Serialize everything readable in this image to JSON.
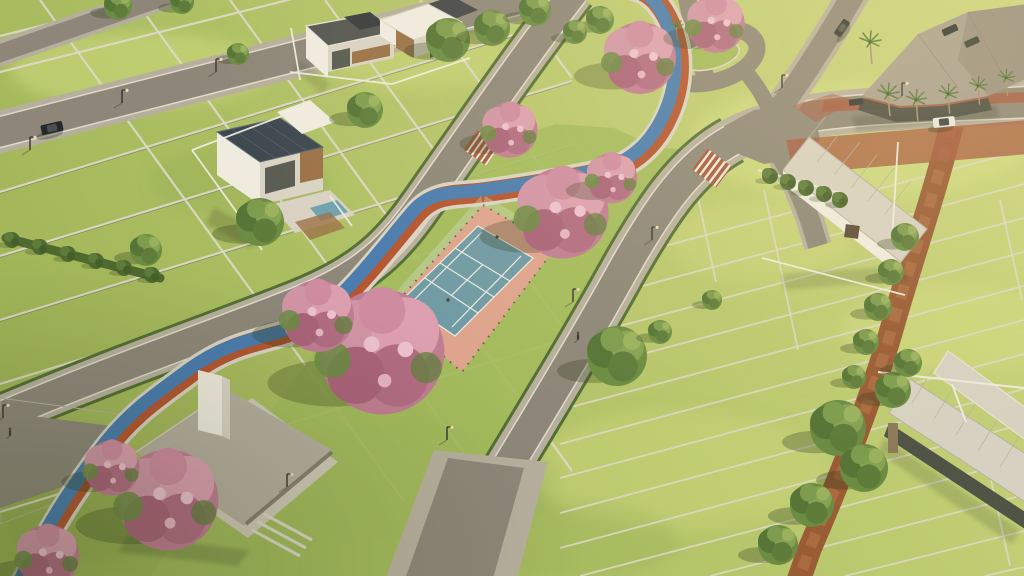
{
  "scene": {
    "type": "aerial-3d-render",
    "description": "High-angle golden-hour drone render of a master-planned residential land development: fenced grass lots in perspective grids, diagonal paved streets, a central linear park with a fenced tennis court, flowering pink ipe trees, a winding blue-and-orange multiuse trail, a hip-roof pavilion, model houses, a palm-fringed clubhouse, a roundabout and a red-brick paved avenue.",
    "time_of_day": "late-afternoon sun from upper right, long soft shadows to lower left",
    "text_visible": "none"
  },
  "palette": {
    "grass_base1": "#9cb254",
    "grass_base2": "#ccd67e",
    "grass_light": "#d6df85",
    "grass_mid": "#aabf60",
    "grass_dark": "#83a047",
    "park_green": "#a3ba5c",
    "asphalt": "#8e8779",
    "sidewalk": "#b7af9d",
    "curb": "#ded9c9",
    "trail_blue": "#4a7cae",
    "trail_red": "#b5552f",
    "trail_base": "#d9d3c3",
    "court_blue": "#6f9aa4",
    "court_apron": "#dea48d",
    "court_line": "#eef0e6",
    "dirt": "#9a5c35",
    "dirt_light": "#ae6f44",
    "brick": "#a6593f",
    "roof_taupe": "#b5ae9d",
    "roof_light": "#d7d1c1",
    "roof_dark": "#a79e8e",
    "roof_facet": "#998f7f",
    "wall": "#efebdf",
    "wall_shade": "#d9d3c4",
    "glass": "#42473f",
    "wood": "#9b7248",
    "solar": "#3d474f",
    "tree_dark": "#556f35",
    "tree_mid": "#6b8c42",
    "tree_light": "#8aa854",
    "bush": "#4e6a30",
    "pink": "#c07d92",
    "pink_light": "#dc9fb0",
    "pink_dark": "#aa6379",
    "car_dark": "#26292c",
    "car_white": "#e9e7e1",
    "pole": "#3c3b33"
  },
  "elements": {
    "lots": {
      "style": "white double-rail fence dividers",
      "left_grid_lines": 11,
      "right_grid_strips": 13
    },
    "roads": [
      "upper-left street",
      "far top-left street",
      "park west street",
      "park east street merging into brick-edged avenue",
      "north spur to roundabout",
      "northeast street",
      "southeast driveway stub"
    ],
    "roundabout": {
      "island": "grass oval with light curb"
    },
    "crosswalks": 2,
    "trail": {
      "colors": [
        "blue cycle lane",
        "terracotta jogging lane"
      ],
      "route": "from bottom-left corner through the linear park to the roundabout"
    },
    "tennis_court": {
      "surface": "teal blue",
      "apron": "salmon",
      "lines": "white",
      "fence": "dark mesh",
      "players": 2
    },
    "pavilion": {
      "roof": "taupe hip roof with white chimney",
      "terrace": "gravel with cafe tables",
      "steps": 3
    },
    "houses": [
      "two-story flat-roof house top-center",
      "flat-roof house with wood slats top-center-right",
      "two-story solar-roof house with plunge pool left",
      "long single-story ribbed-roof house right",
      "long open pavilion house bottom-right"
    ],
    "clubhouse": {
      "roof": "large angular taupe facets",
      "front": "glass",
      "palms": 6
    },
    "vehicles": {
      "moving_dark": 2,
      "moving_white": 1,
      "parked_dark": 3
    },
    "people": 2,
    "streetlights": 10,
    "flowering_trees": 9,
    "green_trees": 24,
    "dirt_path": "red-earth walking track with hedge bushes on right-hand lots"
  }
}
